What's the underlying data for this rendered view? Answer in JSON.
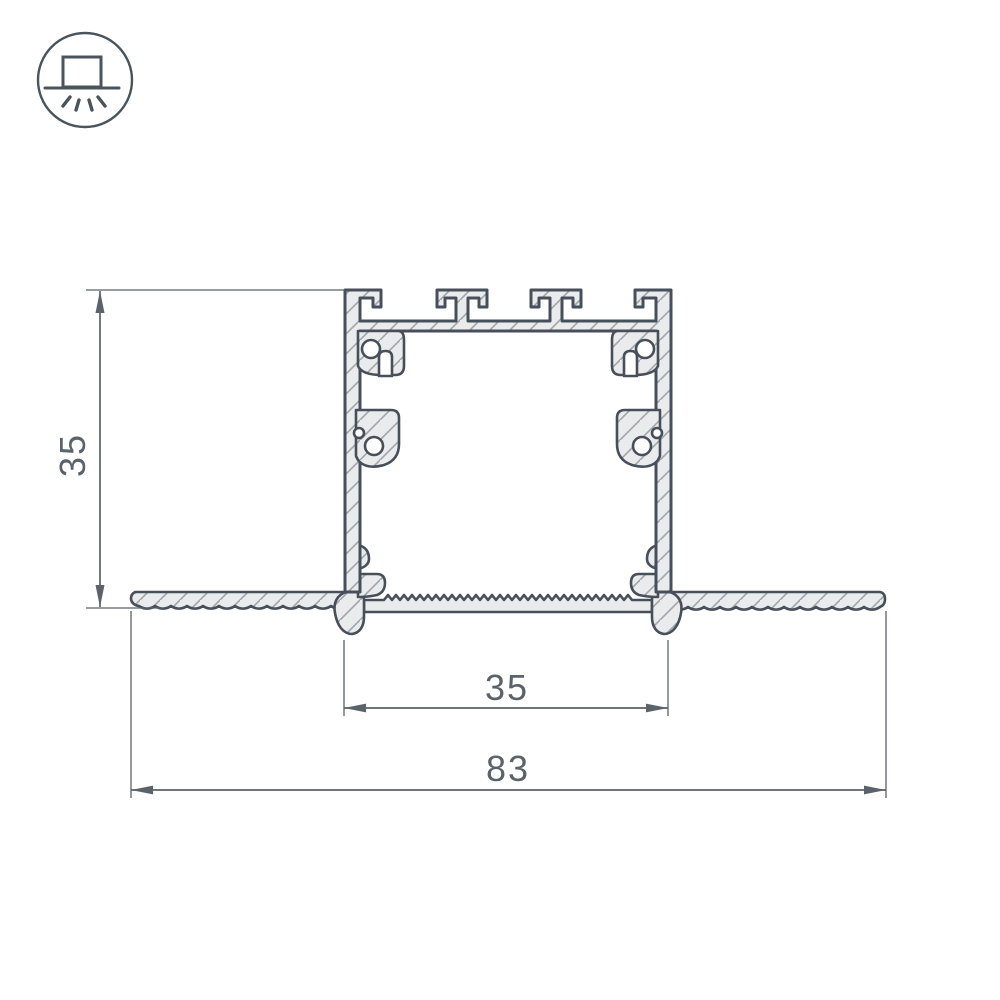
{
  "drawing": {
    "alt": "recessed aluminium LED profile cross-section",
    "background": "#ffffff",
    "icon_badge": {
      "name": "recessed-downlight",
      "stroke": "#4a545c",
      "parts": [
        "fixture-box",
        "ceiling-line",
        "light-rays"
      ]
    },
    "profile": {
      "fill": "#eaebec",
      "outline": "#47505a",
      "hatch_color": "#a0a6ab"
    },
    "dimensions": {
      "color": "#5a626a",
      "height_mm": "35",
      "inner_width_mm": "35",
      "overall_width_mm": "83"
    }
  }
}
